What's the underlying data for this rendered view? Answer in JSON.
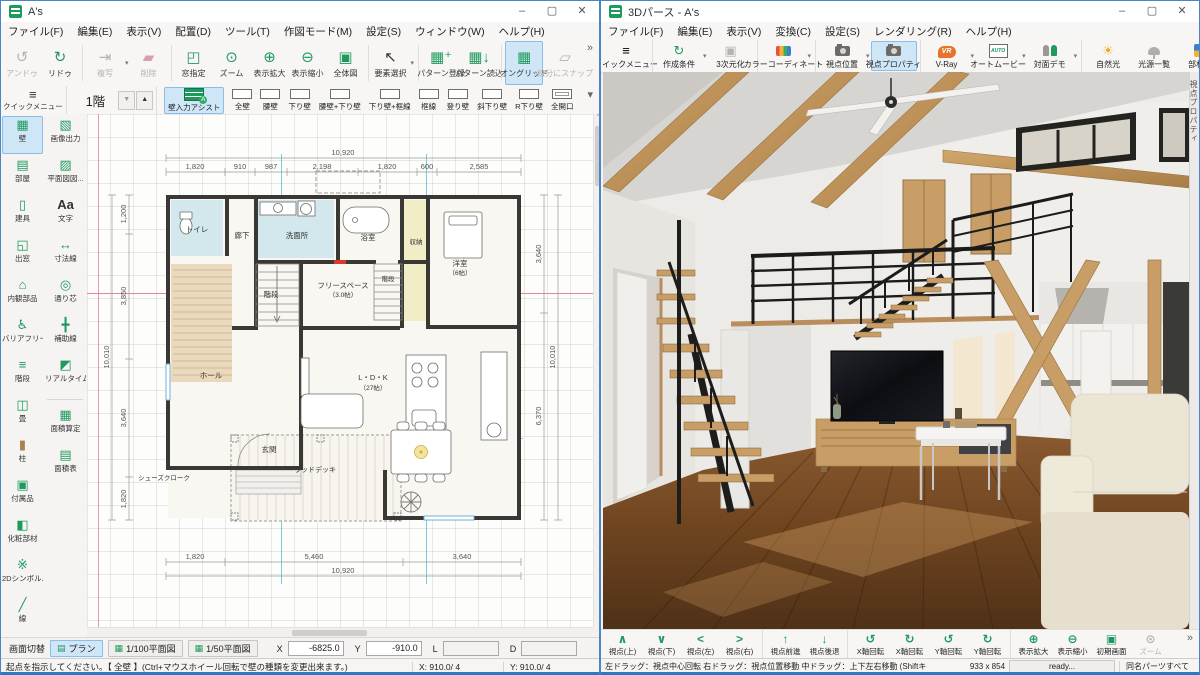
{
  "wl": {
    "title": "A's",
    "menu": [
      "ファイル(F)",
      "編集(E)",
      "表示(V)",
      "配置(D)",
      "ツール(T)",
      "作図モード(M)",
      "設定(S)",
      "ウィンドウ(W)",
      "ヘルプ(H)"
    ],
    "tb1": {
      "undo": "アンドゥ",
      "redo": "リドゥ",
      "copy": "複写",
      "del": "削除",
      "win": "窓指定",
      "zoom": "ズーム",
      "zin": "表示拡大",
      "zout": "表示縮小",
      "whole": "全体図",
      "sel": "要素選択",
      "preg": "パターン登録",
      "pload": "パターン読込",
      "grid": "オングリッド",
      "snap": "線分にスナップ"
    },
    "tb2": {
      "quick": "クイックメニュー",
      "floor": "1階",
      "assist": "壁入力アシスト",
      "walls": [
        "全壁",
        "腰壁",
        "下り壁",
        "腰壁+下り壁",
        "下り壁+框線",
        "框線",
        "登り壁",
        "斜下り壁",
        "R下り壁",
        "全開口"
      ]
    },
    "side1": [
      "壁",
      "部屋",
      "建具",
      "出窓",
      "内観部品",
      "バリアフリー",
      "階段",
      "畳",
      "柱",
      "付属品",
      "化粧部材",
      "2Dシンボル...",
      "線"
    ],
    "side2": [
      "画像出力",
      "平面図図...",
      "文字",
      "寸法線",
      "通り芯",
      "補助線",
      "リアルタイム3D...",
      "面積算定",
      "面積表"
    ],
    "plan": {
      "tt": "10,920",
      "t": [
        "1,820",
        "910",
        "987",
        "2,198",
        "1,820",
        "600",
        "2,585"
      ],
      "bt": "10,920",
      "b": [
        "1,820",
        "5,460",
        "3,640"
      ],
      "lt": "10,010",
      "l": [
        "1,200",
        "3,850",
        "3,640",
        "1,820"
      ],
      "rt": "10,010",
      "r": [
        "3,640",
        "6,370"
      ],
      "rooms": {
        "toilet": "トイレ",
        "corridor": "廊下",
        "wash": "洗面所",
        "bath": "浴室",
        "closet": "収納",
        "bedroom": "洋室",
        "bedroom_size": "（6帖）",
        "stair1": "階段",
        "stair2": "階段",
        "free": "フリースペース",
        "free_size": "（3.0帖）",
        "shoes": "シューズクローク",
        "hall": "ホール",
        "entrance": "玄関",
        "ldk": "L・D・K",
        "ldk_size": "（27帖）",
        "deck": "ウッドデッキ"
      }
    },
    "bb": {
      "switch": "画面切替",
      "plan": "プラン",
      "p100": "1/100平面図",
      "p50": "1/50平面図",
      "x": "X",
      "xv": "-6825.0",
      "y": "Y",
      "yv": "-910.0",
      "l": "L",
      "d": "D"
    },
    "st": {
      "msg": "起点を指示してください。【 全壁 】(Ctrl+マウスホイール回転で壁の種類を変更出来ます。)",
      "x": "X: 910.0/ 4",
      "y": "Y: 910.0/ 4"
    }
  },
  "wr": {
    "title": "3Dパース - A's",
    "menu": [
      "ファイル(F)",
      "編集(E)",
      "表示(V)",
      "変換(C)",
      "設定(S)",
      "レンダリング(R)",
      "ヘルプ(H)"
    ],
    "tb": {
      "quick": "クイックメニュー",
      "cond": "作成条件",
      "to3d": "3次元化",
      "color": "カラーコーディネート",
      "vpos": "視点位置",
      "vprop": "視点プロパティ",
      "vray": "V-Ray",
      "movie": "オートムービー",
      "demo": "対面デモ",
      "sun": "自然光",
      "lights": "光源一覧",
      "mat": "部材色"
    },
    "tab": "視点プロパティ",
    "nav": [
      "視点(上)",
      "視点(下)",
      "視点(左)",
      "視点(右)",
      "視点前進",
      "視点後退",
      "X軸回転",
      "X軸回転",
      "Y軸回転",
      "Y軸回転",
      "表示拡大",
      "表示縮小",
      "初期画面",
      "ズーム"
    ],
    "st": {
      "help": "左ドラッグ：視点中心回転 右ドラッグ：視点位置移動 中ドラッグ：上下左右移動 (Shiftキ",
      "size": "933 x 854",
      "ready": "ready...",
      "parts": "同名パーツすべて"
    }
  }
}
